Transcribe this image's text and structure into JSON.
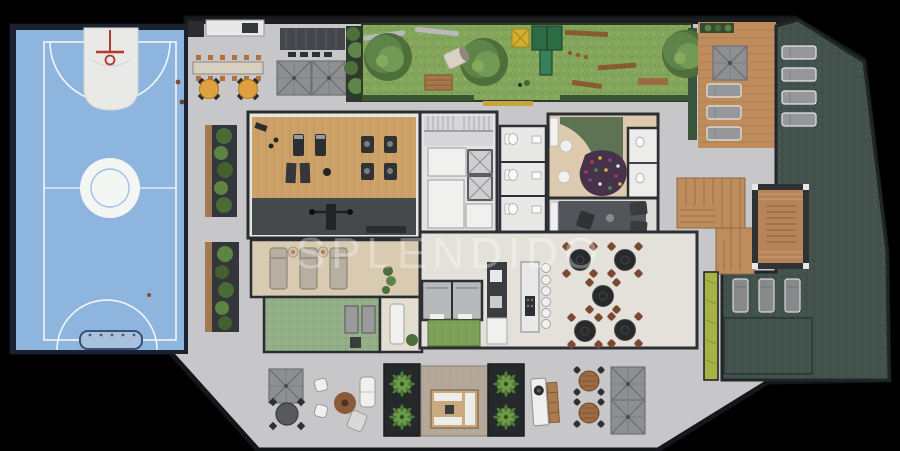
{
  "watermark": {
    "text": "SPLENDIDO"
  },
  "palette": {
    "background": "#000000",
    "walkway": "#c7c7c9",
    "wall": "#23262a",
    "court_blue": "#8db5dd",
    "court_border": "#1a2230",
    "court_line": "#f2f6fa",
    "hoop_red": "#b23a2e",
    "lawn_green": "#83a65b",
    "hedge_green": "#3c5a38",
    "pool_stone_green": "#42514b",
    "wood_deck": "#bf8d5d",
    "gym_wood": "#cda269",
    "gym_rubber": "#46494c",
    "relax_beige": "#d9cab2",
    "kids_floor": "#ddcaae",
    "kids_rug": "#5e7353",
    "ball_pit": "#46324a",
    "lounge_rug": "#54555a",
    "lime_hedge": "#a6b243",
    "table_orange": "#dfa13f",
    "chair_brown": "#7b4a33",
    "garden_sage": "#93af88",
    "yellow_tactile": "#c8a43c"
  },
  "areas": [
    {
      "id": "basketball-court"
    },
    {
      "id": "outdoor-cafe-terrace"
    },
    {
      "id": "lawn-garden"
    },
    {
      "id": "playground"
    },
    {
      "id": "gym"
    },
    {
      "id": "relax-room"
    },
    {
      "id": "zen-garden"
    },
    {
      "id": "building-core"
    },
    {
      "id": "restrooms"
    },
    {
      "id": "kids-playroom"
    },
    {
      "id": "tv-lounge"
    },
    {
      "id": "gourmet-kitchen"
    },
    {
      "id": "dining-area"
    },
    {
      "id": "sauna"
    },
    {
      "id": "sun-deck"
    },
    {
      "id": "gazebo-deck"
    },
    {
      "id": "pool-stone-area"
    },
    {
      "id": "fire-pit-lounge"
    },
    {
      "id": "bbq-grill-area"
    }
  ]
}
